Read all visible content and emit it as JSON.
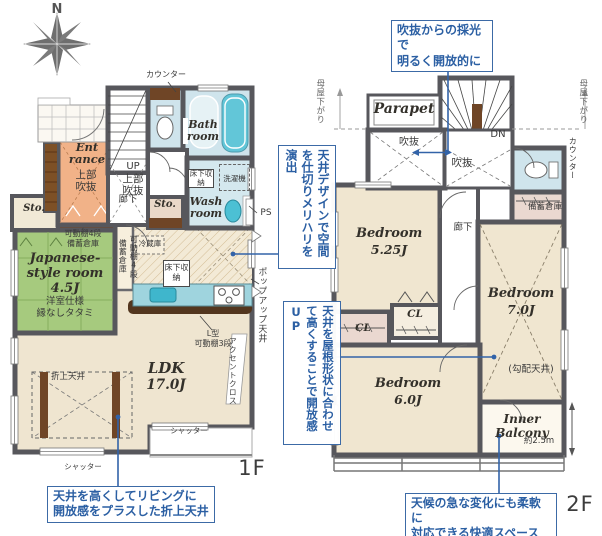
{
  "compass": {
    "north": "N"
  },
  "floor1": {
    "label": "1F",
    "counter_label": "カウンター",
    "bath_room": "Bath room",
    "entrance": "Ent rance",
    "entrance_void": "上部吹抜",
    "up": "UP",
    "stair_void": "上部吹抜",
    "hallway": "廊下",
    "storage_left": "Sto.",
    "storage_mid": "Sto.",
    "underfloor_storage_wash": "床下収納",
    "washing_machine": "洗濯機",
    "wash_room": "Wash room",
    "pipe_space": "PS",
    "jp_closet_line1": "可動棚4段",
    "jp_closet_line2": "備蓄倉庫",
    "jp_room_line1": "Japanese-",
    "jp_room_line2": "style room",
    "jp_room_line3": "4.5J",
    "jp_room_line4": "洋室仕様",
    "jp_room_line5": "縁なしタタミ",
    "pantry_shelf_v": "可動棚4段",
    "pantry_v": "備蓄倉庫",
    "fridge": "冷蔵庫",
    "underfloor_storage_kitchen": "床下収納",
    "l_shelf_line1": "L型",
    "l_shelf_line2": "可動棚3段",
    "accent_cloth": "アクセントクロス",
    "popup_ceiling": "ポップアップ天井",
    "coffered_ceiling": "折上天井",
    "ldk_line1": "LDK",
    "ldk_line2": "17.0J",
    "shutter_left": "シャッター",
    "shutter_right": "シャッター"
  },
  "floor2": {
    "label": "2F",
    "parapet": "Parapet",
    "void_left": "吹抜",
    "void_right": "吹抜",
    "down": "DN",
    "roof_slope_left": "母屋下がり",
    "roof_slope_right": "母屋下がり",
    "counter_label": "カウンター",
    "storage": "備蓄倉庫",
    "hallway": "廊下",
    "bedroom1_line1": "Bedroom",
    "bedroom1_line2": "5.25J",
    "bedroom2_line1": "Bedroom",
    "bedroom2_line2": "7.0J",
    "sloped_ceiling": "(勾配天井)",
    "closet1": "CL",
    "closet2": "CL",
    "bedroom3_line1": "Bedroom",
    "bedroom3_line2": "6.0J",
    "inner_balcony": "Inner Balcony",
    "balcony_depth": "約2.5m"
  },
  "callouts": {
    "skylight_line1": "吹抜からの採光で",
    "skylight_line2": "明るく開放的に",
    "ceiling_design_v": "天井デザインで空間を仕切りメリハリを演出",
    "roof_shape_v": "天井を屋根形状に合わせて高くすることで開放感UP",
    "coffered_line1": "天井を高くしてリビングに",
    "coffered_line2": "開放感をプラスした折上天井",
    "weather_line1": "天候の急な変化にも柔軟に",
    "weather_line2": "対応できる快適スペース"
  },
  "colors": {
    "wall": "#57575c",
    "floor_cream": "#f0e6d0",
    "tatami_green": "#a6ca7e",
    "entrance_orange": "#f1b288",
    "wet_blue": "#cfe4ec",
    "counter_cyan": "#9fd4de",
    "wood_brown": "#6f4526",
    "callout_blue": "#2b5fa3"
  }
}
